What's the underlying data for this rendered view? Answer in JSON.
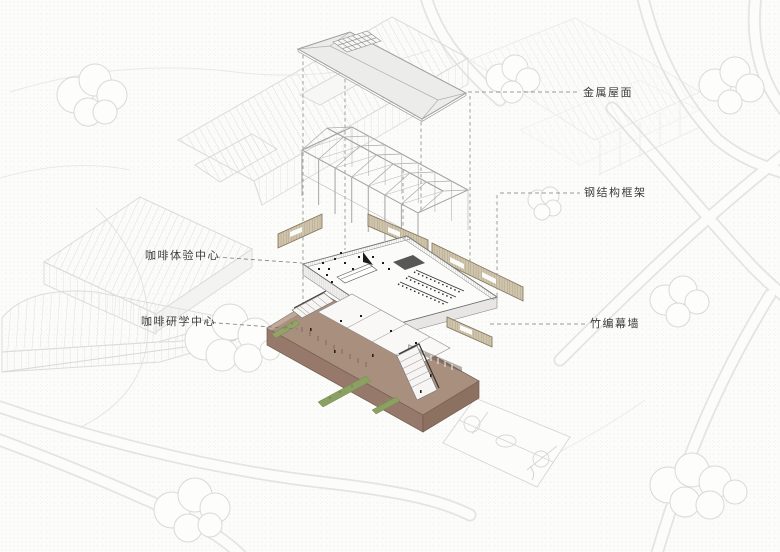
{
  "diagram": {
    "callouts": {
      "metal_roof": "金属屋面",
      "steel_frame": "钢结构框架",
      "coffee_experience_center": "咖啡体验中心",
      "coffee_study_center": "咖啡研学中心",
      "bamboo_curtain_wall": "竹编幕墙"
    },
    "colors": {
      "base_brown_top": "#a98f7e",
      "base_brown_side": "#96796a",
      "base_brown_side_dark": "#8c7060",
      "bamboo_tan": "#cfc5ac",
      "roof_gray": "#ececea",
      "frame_line": "#adadab",
      "planting_green": "#8da063",
      "context_line": "#dcdcda",
      "label_text": "#3c3c3c"
    }
  }
}
